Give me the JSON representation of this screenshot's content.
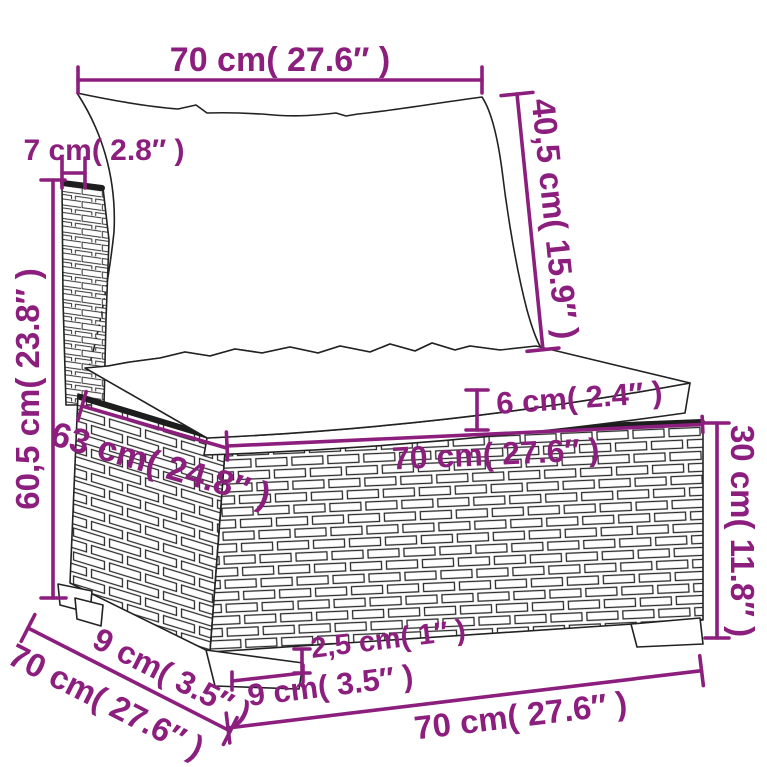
{
  "diagram": {
    "title": "poly-rattan modular middle sofa dimension drawing",
    "accent_color": "#8C1E7E",
    "outline_color": "#222222",
    "labels": {
      "back_cushion_width": "70 cm( 27.6″ )",
      "back_panel_thickness": "7 cm( 2.8″ )",
      "back_cushion_height": "40,5 cm( 15.9″ )",
      "overall_height": "60,5 cm( 23.8″ )",
      "seat_cushion_thickness": "6 cm( 2.4″ )",
      "seat_depth": "63 cm( 24.8″ )",
      "seat_width": "70 cm( 27.6″ )",
      "base_height": "30 cm( 11.8″ )",
      "leg_inset_depth": "9 cm( 3.5″ )",
      "overall_depth": "70 cm( 27.6″ )",
      "leg_height": "2,5 cm( 1″ )",
      "leg_width": "9 cm( 3.5″ )",
      "overall_width": "70 cm( 27.6″ )"
    }
  }
}
